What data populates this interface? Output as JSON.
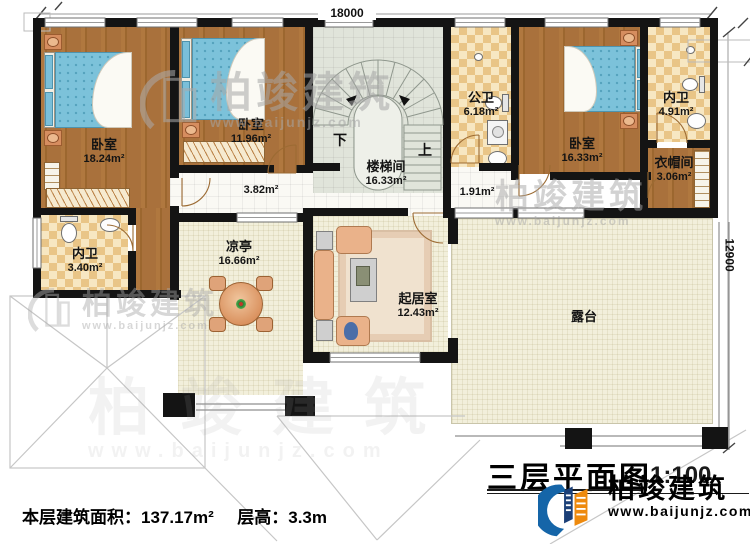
{
  "plan": {
    "title": "三层平面图",
    "scale": "1:100",
    "area_label": "本层建筑面积：",
    "area_value": "137.17m²",
    "height_label": "层高：",
    "height_value": "3.3m"
  },
  "dimensions": {
    "width": "18000",
    "height": "12900"
  },
  "rooms": {
    "bedroom1": {
      "name": "卧室",
      "area": "18.24m²"
    },
    "bedroom2": {
      "name": "卧室",
      "area": "11.96m²"
    },
    "stairwell": {
      "name": "楼梯间",
      "area": "16.33m²"
    },
    "public_bath": {
      "name": "公卫",
      "area": "6.18m²"
    },
    "bedroom3": {
      "name": "卧室",
      "area": "16.33m²"
    },
    "ensuite_right": {
      "name": "内卫",
      "area": "4.91m²"
    },
    "cloakroom": {
      "name": "衣帽间",
      "area": "3.06m²"
    },
    "ensuite_left": {
      "name": "内卫",
      "area": "3.40m²"
    },
    "pavilion": {
      "name": "凉亭",
      "area": "16.66m²"
    },
    "living": {
      "name": "起居室",
      "area": "12.43m²"
    },
    "terrace": {
      "name": "露台"
    }
  },
  "halls": {
    "hall1": "3.82m²",
    "hall2": "1.91m²"
  },
  "stairs": {
    "down": "下",
    "up": "上"
  },
  "watermark": {
    "brand": "柏竣建筑",
    "url": "www.baijunjz.com"
  },
  "logo": {
    "brand": "柏竣建筑",
    "url": "www.baijunjz.com"
  },
  "colors": {
    "wall": "#141414",
    "wood": "#a9713c",
    "tile": "#eccb90",
    "terrace_floor": "#f2efdb",
    "bed_blue": "#7cc2da",
    "logo_blue": "#1565a8",
    "logo_orange": "#ee8a0e"
  }
}
